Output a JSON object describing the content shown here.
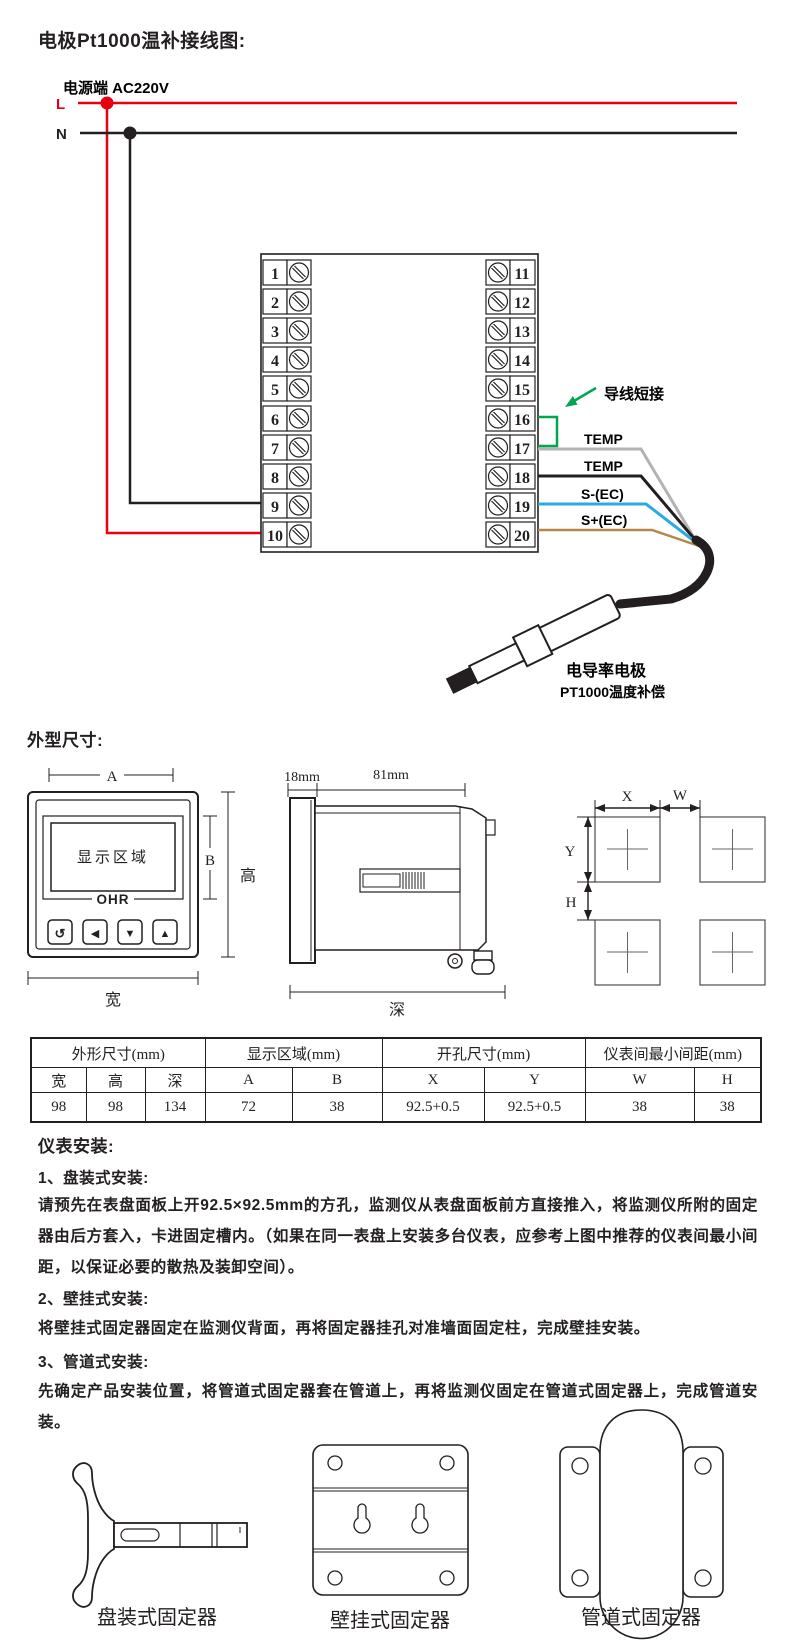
{
  "page": {
    "title": "电极Pt1000温补接线图:"
  },
  "wiring": {
    "power_label": "电源端  AC220V",
    "line_l": "L",
    "line_n": "N",
    "terminals_left": [
      "1",
      "2",
      "3",
      "4",
      "5",
      "6",
      "7",
      "8",
      "9",
      "10"
    ],
    "terminals_right": [
      "11",
      "12",
      "13",
      "14",
      "15",
      "16",
      "17",
      "18",
      "19",
      "20"
    ],
    "jumper_label": "导线短接",
    "wire_labels": [
      "TEMP",
      "TEMP",
      "S-(EC)",
      "S+(EC)"
    ],
    "electrode_name": "电导率电极",
    "electrode_sub": "PT1000温度补偿",
    "colors": {
      "live": "#e60012",
      "neutral": "#231f20",
      "jumper": "#00a651",
      "temp_gray": "#b3b3b3",
      "s_minus_blue": "#29abe2",
      "s_plus_brown": "#b5884a"
    }
  },
  "dims": {
    "heading": "外型尺寸:",
    "front": {
      "dim_a": "A",
      "dim_b": "B",
      "height_label": "高",
      "width_label": "宽",
      "display_label": "显示区域",
      "brand": "OHR",
      "buttons": [
        "↺",
        "◀",
        "▼",
        "▲"
      ]
    },
    "side": {
      "d18": "18mm",
      "d81": "81mm",
      "depth_label": "深"
    },
    "cutout": {
      "x": "X",
      "w": "W",
      "y": "Y",
      "h": "H"
    }
  },
  "table": {
    "groups": [
      "外形尺寸(mm)",
      "显示区域(mm)",
      "开孔尺寸(mm)",
      "仪表间最小间距(mm)"
    ],
    "columns": [
      "宽",
      "高",
      "深",
      "A",
      "B",
      "X",
      "Y",
      "W",
      "H"
    ],
    "values": [
      "98",
      "98",
      "134",
      "72",
      "38",
      "92.5+0.5",
      "92.5+0.5",
      "38",
      "38"
    ]
  },
  "install": {
    "heading": "仪表安装:",
    "s1_title": "1、盘装式安装:",
    "s1_body": "请预先在表盘面板上开92.5×92.5mm的方孔，监测仪从表盘面板前方直接推入，将监测仪所附的固定器由后方套入，卡进固定槽内。（如果在同一表盘上安装多台仪表，应参考上图中推荐的仪表间最小间距，以保证必要的散热及装卸空间）。",
    "s2_title": "2、壁挂式安装:",
    "s2_body": "将壁挂式固定器固定在监测仪背面，再将固定器挂孔对准墙面固定柱，完成壁挂安装。",
    "s3_title": "3、管道式安装:",
    "s3_body": "先确定产品安装位置，将管道式固定器套在管道上，再将监测仪固定在管道式固定器上，完成管道安装。"
  },
  "fixtures": {
    "labels": [
      "盘装式固定器",
      "壁挂式固定器",
      "管道式固定器"
    ]
  }
}
